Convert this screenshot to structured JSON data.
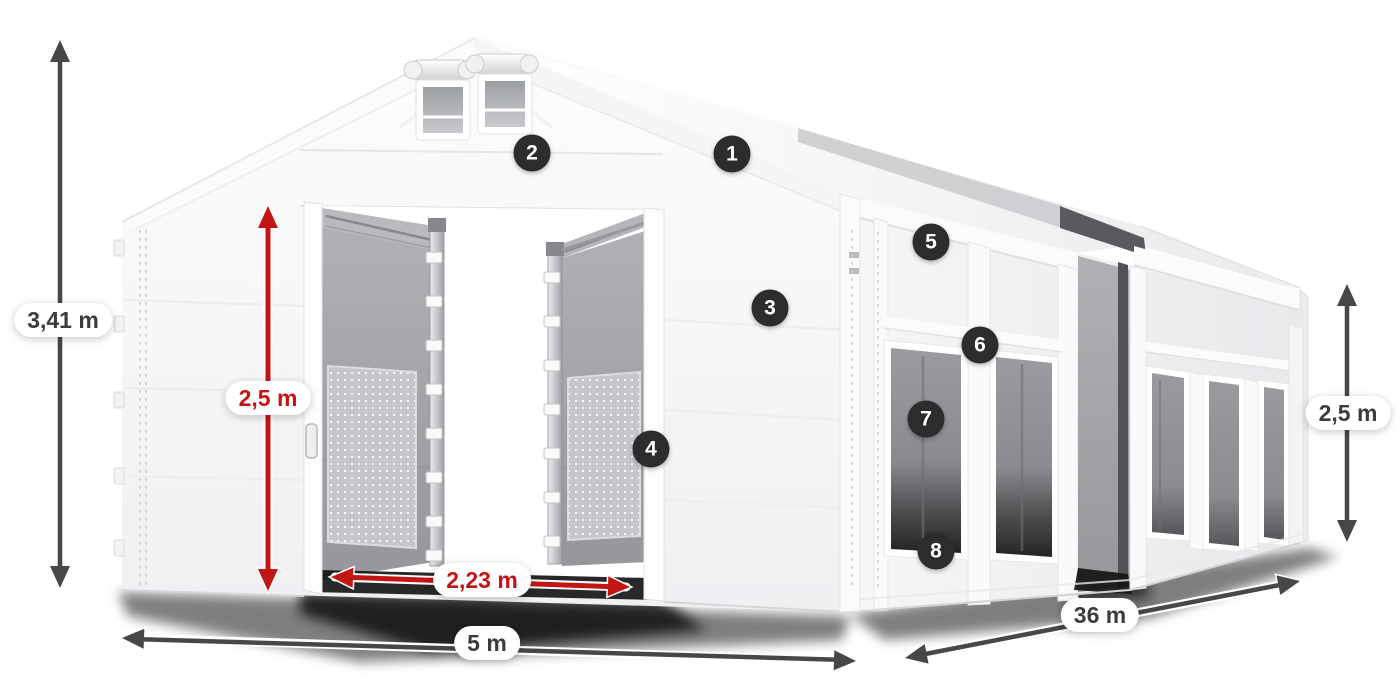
{
  "scene": {
    "subject": "White PVC storage tent 5 x 36 m with open gable entrance, numbered feature callouts and dimension arrows",
    "background": "#ffffff"
  },
  "style": {
    "badge_bg": "#2c2c2e",
    "badge_text": "#ffffff",
    "dim_gray": "#47474a",
    "dim_red": "#c21515",
    "pill_bg": "#ffffff"
  },
  "badges": [
    {
      "label": "1"
    },
    {
      "label": "2"
    },
    {
      "label": "3"
    },
    {
      "label": "4"
    },
    {
      "label": "5"
    },
    {
      "label": "6"
    },
    {
      "label": "7"
    },
    {
      "label": "8"
    }
  ],
  "dimensions": {
    "total_height": {
      "label": "3,41 m",
      "color": "gray"
    },
    "door_height": {
      "label": "2,5 m",
      "color": "red"
    },
    "door_width": {
      "label": "2,23 m",
      "color": "red"
    },
    "front_width": {
      "label": "5 m",
      "color": "gray"
    },
    "side_length": {
      "label": "36 m",
      "color": "gray"
    },
    "side_height": {
      "label": "2,5 m",
      "color": "gray"
    }
  }
}
